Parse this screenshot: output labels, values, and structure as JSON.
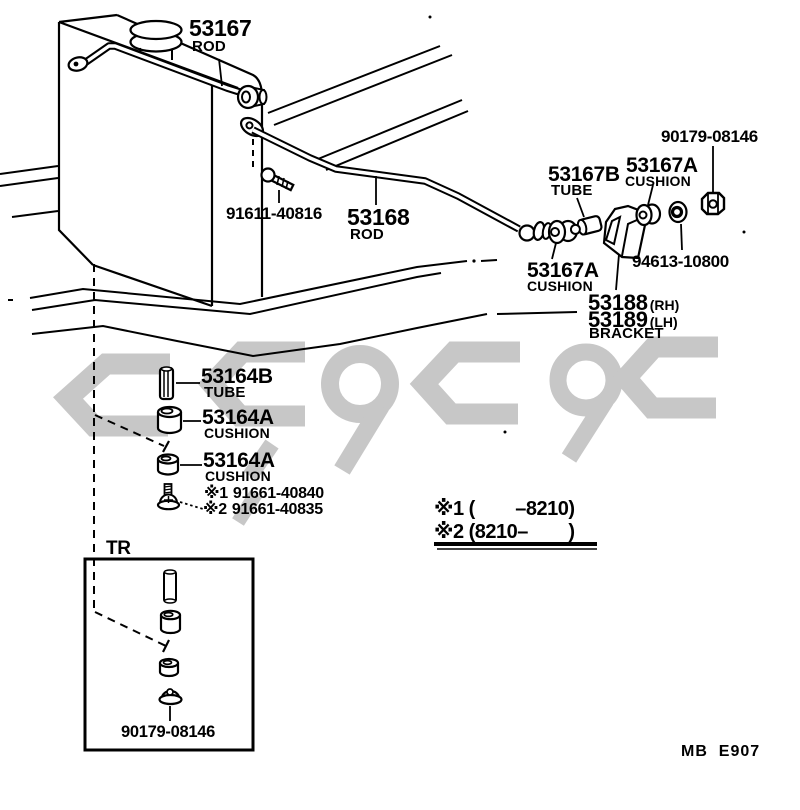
{
  "page": {
    "background": "#ffffff",
    "ink": "#000000",
    "watermark_color": "#c7c7c7",
    "footer_code": "MB  E907"
  },
  "parts": {
    "rod_upper": {
      "number": "53167",
      "label": "ROD"
    },
    "bolt": {
      "number": "91611-40816"
    },
    "rod_lower": {
      "number": "53168",
      "label": "ROD"
    },
    "tube_b": {
      "number": "53167B",
      "label": "TUBE"
    },
    "cushion_right": {
      "number": "53167A",
      "label": "CUSHION"
    },
    "cushion_left": {
      "number": "53167A",
      "label": "CUSHION"
    },
    "nut_top": {
      "number": "90179-08146"
    },
    "washer": {
      "number": "94613-10800"
    },
    "bracket": {
      "rh_number": "53188",
      "rh_side": "(RH)",
      "lh_number": "53189",
      "lh_side": "(LH)",
      "label": "BRACKET"
    },
    "tube_64": {
      "number": "53164B",
      "label": "TUBE"
    },
    "cushion_64_upper": {
      "number": "53164A",
      "label": "CUSHION"
    },
    "cushion_64_lower": {
      "number": "53164A",
      "label": "CUSHION"
    },
    "screw_old": {
      "marker": "※1",
      "number": "91661-40840"
    },
    "screw_new": {
      "marker": "※2",
      "number": "91661-40835"
    }
  },
  "inset": {
    "label": "TR",
    "nut_number": "90179-08146"
  },
  "notes": {
    "line1": "※1 (        –8210)",
    "line2": "※2 (8210–        )"
  }
}
